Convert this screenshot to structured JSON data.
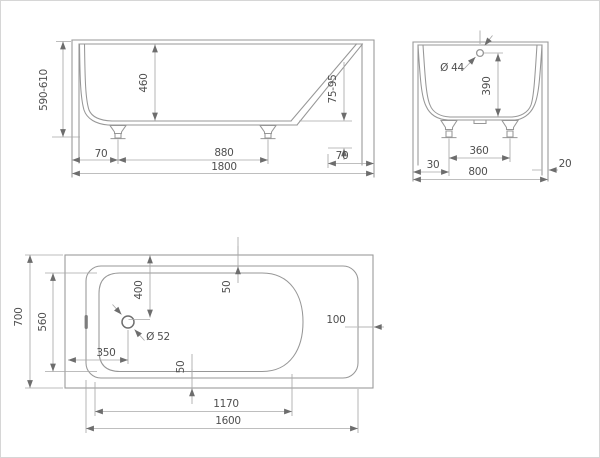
{
  "drawing_title": "bathtub-dimension-drawing",
  "colors": {
    "outline": "#979797",
    "dimension_line": "#a8a8a8",
    "arrow": "#6d6d6d",
    "text": "#4f4f4f",
    "border": "#d6d6d6"
  },
  "side_view": {
    "height": "590-610",
    "depth": "460",
    "foot_height": "75-95",
    "front_offset": "70",
    "feet_spacing": "880",
    "back_offset": "70",
    "length": "1800"
  },
  "end_view": {
    "overflow_diameter": "Ø 44",
    "overflow_height": "390",
    "left_offset": "30",
    "feet_spacing": "360",
    "width": "800",
    "rim_thickness": "20"
  },
  "plan_view": {
    "width": "700",
    "basin_width": "560",
    "drain_from_end": "400",
    "rim_gap_top": "50",
    "drain_from_side": "350",
    "drain_diameter": "Ø 52",
    "rim_gap_bottom": "50",
    "rim_gap_right": "100",
    "basin_length": "1170",
    "length": "1600"
  }
}
